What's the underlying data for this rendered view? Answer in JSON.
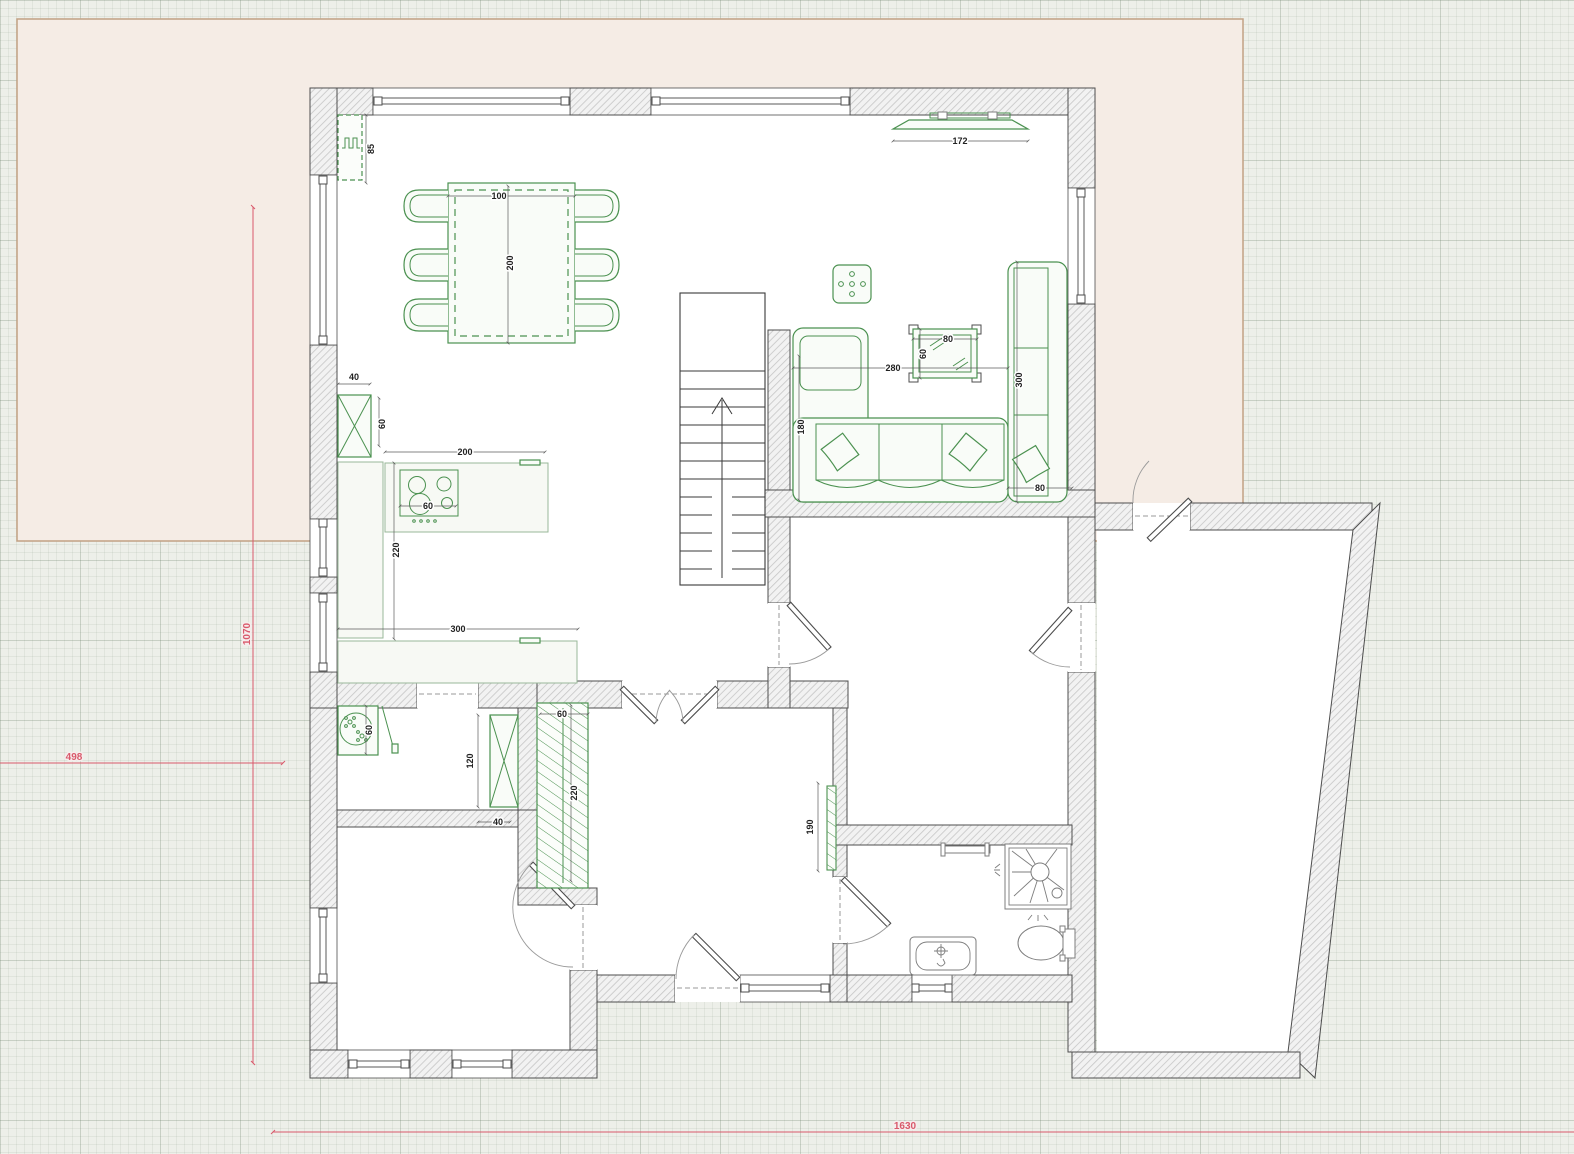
{
  "view": {
    "type": "floor-plan-canvas",
    "floor": "ground-floor"
  },
  "colors": {
    "furniture_green": "#4b9150",
    "dimension_red": "#d9596b",
    "terrain_fill": "#f5ece5",
    "terrain_border": "#c2a184",
    "grid_bg": "#edefe9",
    "wall_hatch": "#c9c9c9"
  },
  "dimensions": {
    "site": {
      "height": "1070",
      "width": "498",
      "length": "1630"
    },
    "furniture": {
      "radiator_length": "85",
      "dining_table_width": "100",
      "dining_table_length": "200",
      "tv_width": "172",
      "kitchen_cabinet_width": "40",
      "kitchen_cabinet_depth": "60",
      "kitchen_counter_length": "200",
      "hob_width": "60",
      "kitchen_run_length": "220",
      "kitchen_counter2_length": "300",
      "sofa_width": "280",
      "coffee_table_width": "80",
      "coffee_table_depth": "60",
      "sofa_left_depth": "180",
      "sofa_right_length": "300",
      "sofa_right_depth": "80",
      "washer_width": "60",
      "utility_cabinet_height": "120",
      "utility_gap": "40",
      "wardrobe_width": "60",
      "wardrobe_length": "220",
      "hall_radiator_length": "190"
    }
  }
}
